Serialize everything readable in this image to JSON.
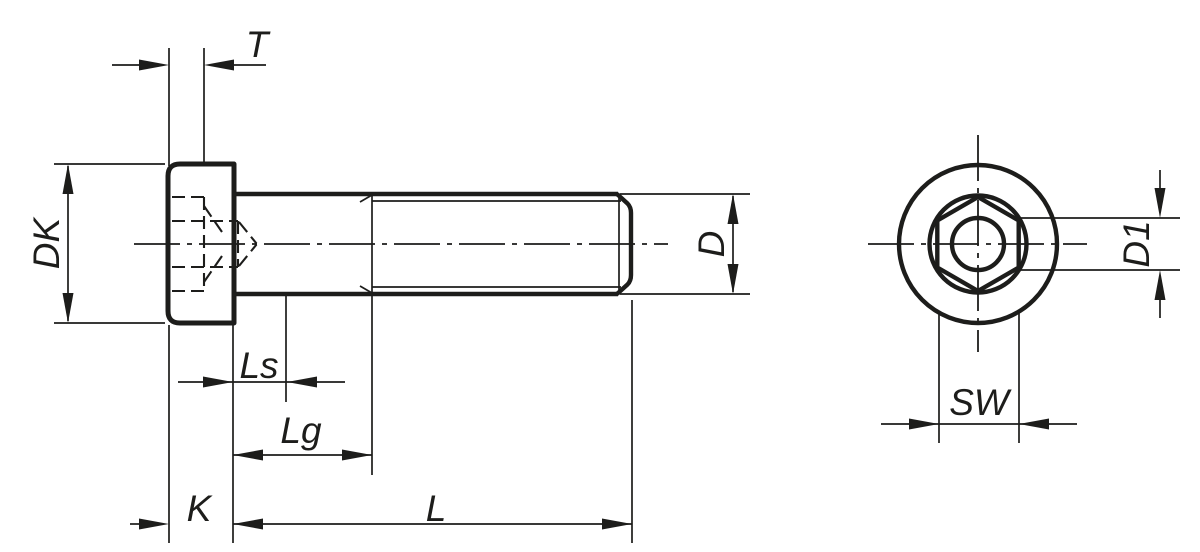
{
  "colors": {
    "line": "#1d1d1b",
    "background": "#ffffff"
  },
  "drawing": {
    "type": "technical-drawing",
    "subject": "Socket head cap screw with hexagon socket and pilot recess — longitudinal side view and end view",
    "labels": {
      "t": "T",
      "dk": "DK",
      "d": "D",
      "ls": "Ls",
      "lg": "Lg",
      "k": "K",
      "l": "L",
      "d1": "D1",
      "sw": "SW"
    }
  }
}
